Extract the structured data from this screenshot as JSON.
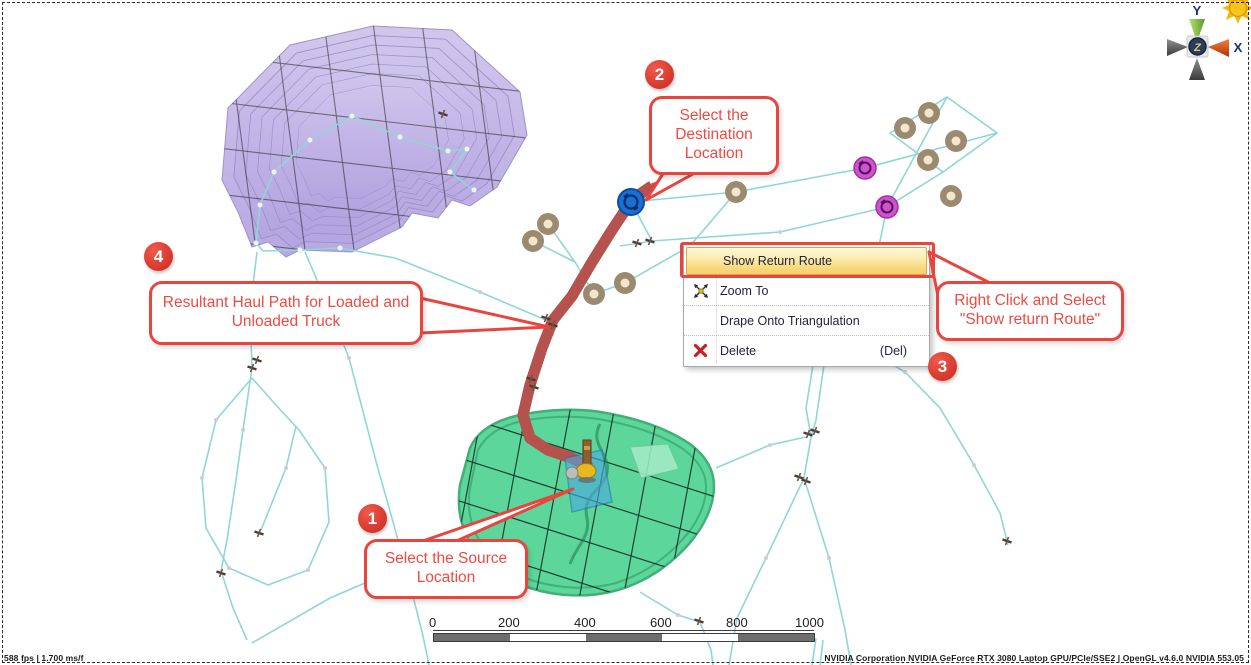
{
  "context_menu": {
    "items": [
      {
        "label": "Show Return Route",
        "highlighted": true
      },
      {
        "label": "Zoom To",
        "icon": "zoom-extents-icon"
      },
      {
        "label": "Drape Onto Triangulation"
      },
      {
        "label": "Delete",
        "icon": "delete-icon",
        "shortcut": "(Del)"
      }
    ]
  },
  "callouts": [
    {
      "number": "1",
      "text": "Select the Source Location"
    },
    {
      "number": "2",
      "text": "Select the Destination Location"
    },
    {
      "number": "3",
      "text": "Right Click and Select \"Show return Route\""
    },
    {
      "number": "4",
      "text": "Resultant Haul Path for Loaded and Unloaded Truck"
    }
  ],
  "scalebar": {
    "ticks": [
      "0",
      "200",
      "400",
      "600",
      "800",
      "1000"
    ]
  },
  "status_bar": {
    "left": "588 fps | 1.700 ms/f",
    "right": "NVIDIA Corporation NVIDIA GeForce RTX 3080 Laptop GPU/PCIe/SSE2 | OpenGL v4.6.0 NVIDIA 553.05"
  },
  "axis_gizmo": {
    "x_label": "X",
    "y_label": "Y",
    "z_label": "Z"
  },
  "colors": {
    "annotation_red": "#e8453f",
    "menu_highlight": "#f8d97e",
    "string_cyan": "#8fd6d8",
    "dump_purple": "#8a66c6",
    "pit_green": "#46d18e",
    "node_brown": "#9b8a70",
    "node_magenta": "#cc55cc",
    "destination_blue": "#1a6fd4",
    "haul_road_red": "#bb5450"
  }
}
